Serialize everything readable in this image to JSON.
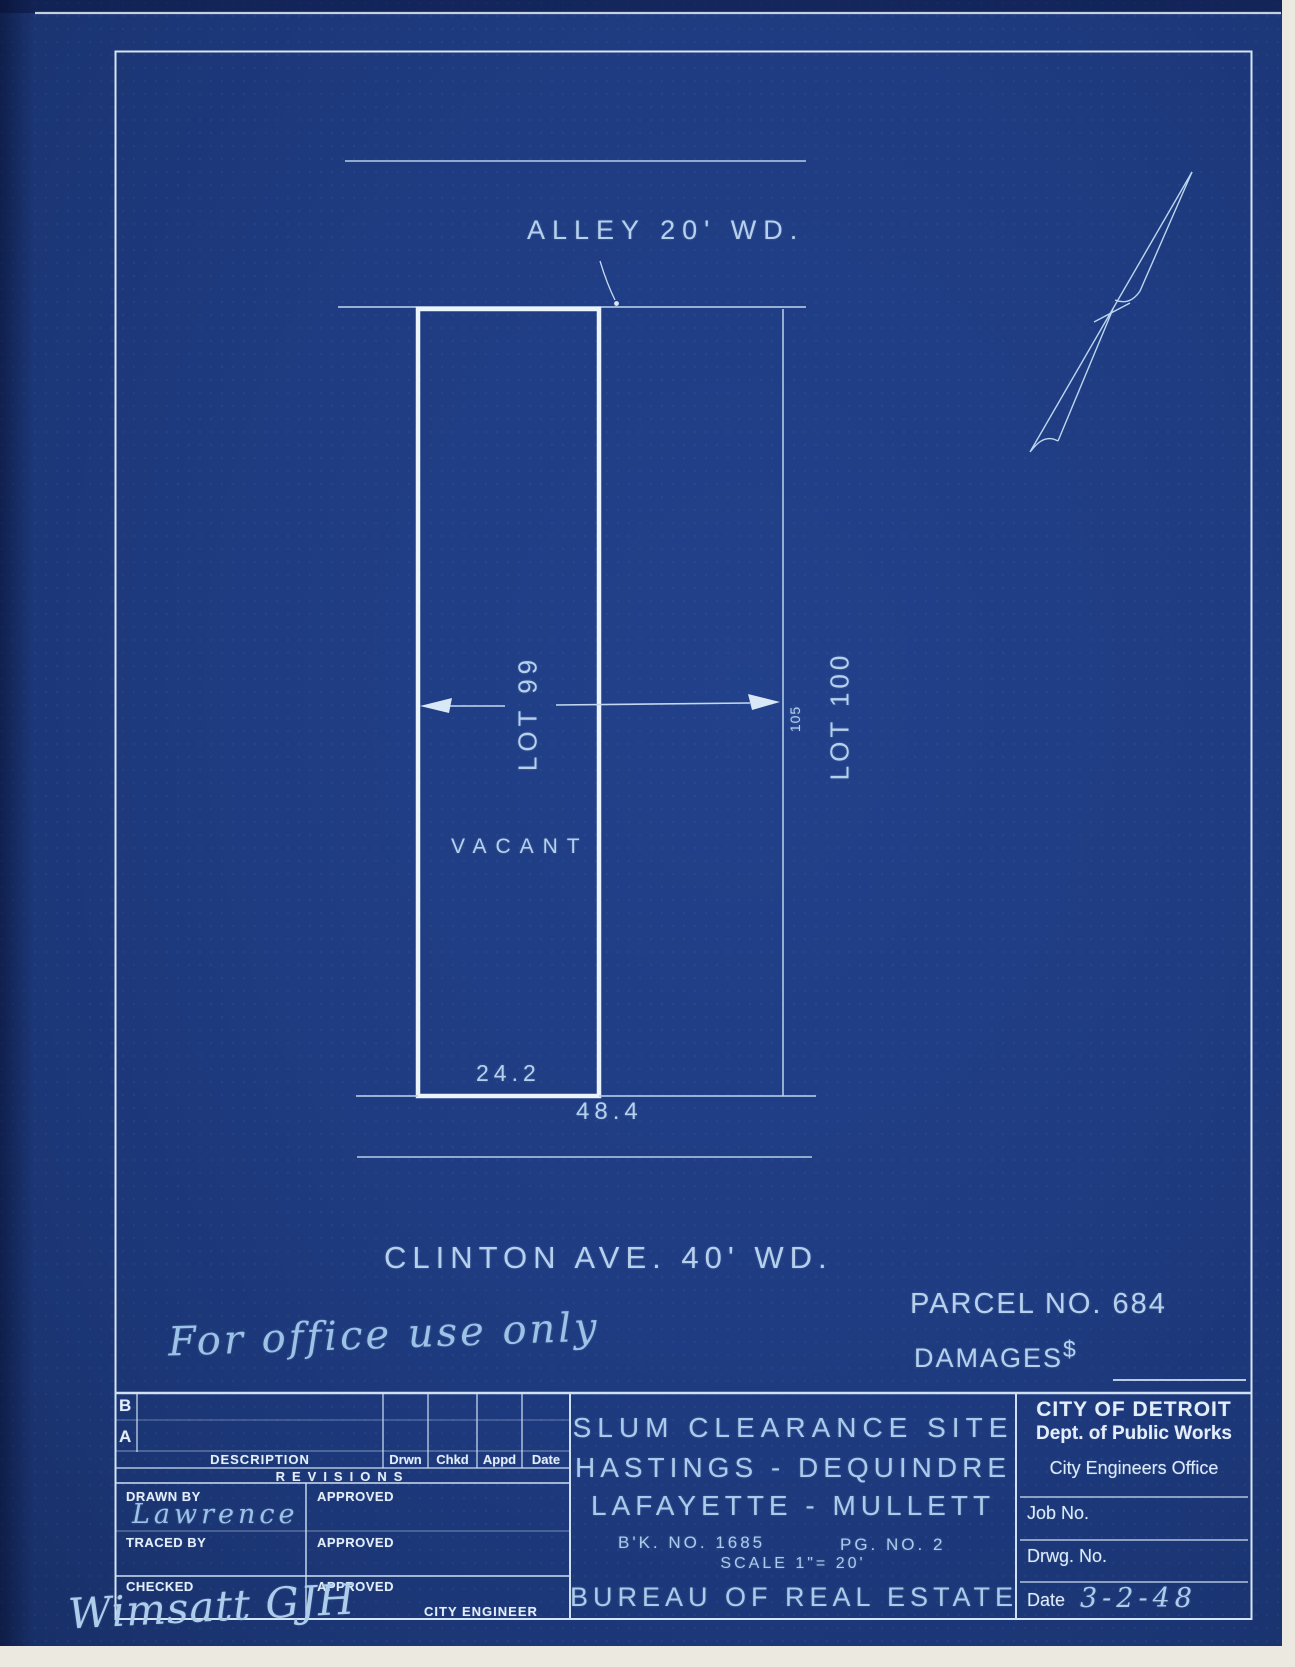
{
  "drawing": {
    "alley_label": "ALLEY 20' WD.",
    "lot99_label": "LOT 99",
    "lot100_label": "LOT 100",
    "lot_depth_dim": "105",
    "vacant_label": "VACANT",
    "frontage_dim": "24.2",
    "total_frontage_dim": "48.4",
    "street_label": "CLINTON AVE. 40' WD.",
    "parcel_no": "PARCEL NO. 684",
    "damages_label": "DAMAGES",
    "damages_currency": "$",
    "office_note": "For office use only"
  },
  "icons": {
    "north_arrow": "north-arrow-icon"
  },
  "title_block": {
    "revision_table": {
      "row_b_label": "B",
      "row_a_label": "A",
      "description_header": "DESCRIPTION",
      "columns": [
        "Drwn",
        "Chkd",
        "Appd",
        "Date"
      ],
      "table_title": "REVISIONS",
      "drawn_by_label": "DRAWN BY",
      "drawn_by_value": "Lawrence",
      "approved_label": "APPROVED",
      "traced_by_label": "TRACED BY",
      "checked_label": "CHECKED",
      "checked_signature": "Wimsatt GJH",
      "city_engineer_label": "CITY ENGINEER"
    },
    "project": {
      "title_line1": "SLUM CLEARANCE SITE",
      "title_line2": "HASTINGS - DEQUINDRE",
      "title_line3": "LAFAYETTE - MULLETT",
      "book_no": "B'K. NO. 1685",
      "page_no": "PG. NO. 2",
      "scale": "SCALE 1\"= 20'",
      "bureau": "BUREAU OF REAL ESTATE"
    },
    "agency": {
      "line1": "CITY OF DETROIT",
      "line2": "Dept. of Public Works",
      "line3": "City Engineers Office",
      "job_no_label": "Job No.",
      "drwg_no_label": "Drwg. No.",
      "date_label": "Date",
      "date_value": "3-2-48"
    }
  },
  "colors": {
    "sheet_blue": "#1f3c82",
    "line_light": "#b8d0ea",
    "line_bright": "#ecf4fb",
    "handwriting": "#9cc2e6",
    "scan_margin": "#ece9e0"
  }
}
